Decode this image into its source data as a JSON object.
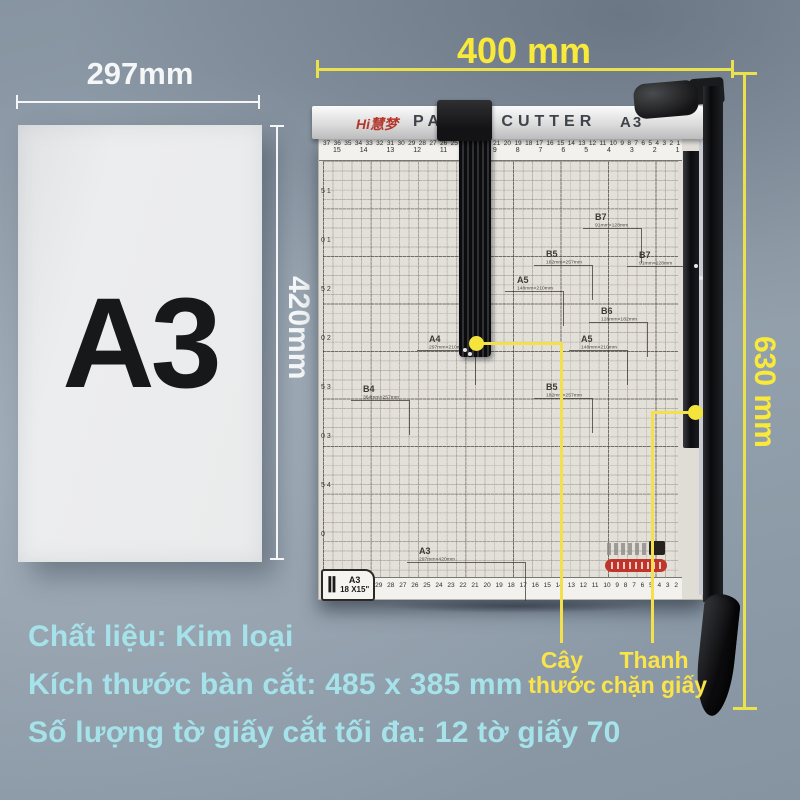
{
  "paper": {
    "label": "A3",
    "width_dim": "297mm",
    "height_dim": "420mm"
  },
  "cutter": {
    "brand": "Hi慧梦",
    "title": "PAPER CUTTER",
    "model": "A3",
    "width_dim": "400 mm",
    "height_dim": "630 mm",
    "corner_tag": {
      "numeral": "Ⅱ",
      "size": "A3",
      "dims": "18 X15\""
    },
    "ruler": {
      "top_row1": "37 36 35 34 33 32 31 30 29 28 27 26 25 24 23 22 21 20 19 18 17 16 15 14 13 12 11 10 9 8 7 6 5 4 3 2 1",
      "top_row2": "15 14 13 12 11 10 9 8 7 6 5 4 3 2 1",
      "bottom_row": "33 32 31 30 29 28 27 26 25 24 23 22 21 20 19 18 17 16 15 14 13 12 11 10 9 8 7 6 5 4 3 2",
      "left_scale": "5 10 15 20 25 30 35 40"
    },
    "markers": [
      {
        "name": "B7",
        "dims": "91mm×128mm"
      },
      {
        "name": "B5",
        "dims": "182mm×257mm"
      },
      {
        "name": "B7",
        "dims": "91mm×128mm"
      },
      {
        "name": "A5",
        "dims": "148mm×210mm"
      },
      {
        "name": "B6",
        "dims": "128mm×182mm"
      },
      {
        "name": "A4",
        "dims": "297mm×210mm"
      },
      {
        "name": "A5",
        "dims": "148mm×210mm"
      },
      {
        "name": "B4",
        "dims": "364mm×257mm"
      },
      {
        "name": "B5",
        "dims": "182mm×257mm"
      },
      {
        "name": "A3",
        "dims": "297mm×420mm"
      }
    ]
  },
  "callouts": [
    {
      "line1": "Cây",
      "line2": "thước"
    },
    {
      "line1": "Thanh",
      "line2": "chặn giấy"
    }
  ],
  "specs": [
    {
      "text": "Chất liệu: Kim loại"
    },
    {
      "text": "Kích thước bàn cắt: 485 x 385 mm"
    },
    {
      "text": "Số lượng tờ giấy cắt tối đa: 12 tờ giấy 70"
    }
  ],
  "colors": {
    "dimension_yellow": "#e9e24d",
    "text_yellow": "#f8e93a",
    "label_yellow": "#fbe34a",
    "spec_cyan": "#a5e2ea",
    "dimension_white": "#f4f6f7",
    "brand_red": "#b5372c"
  }
}
